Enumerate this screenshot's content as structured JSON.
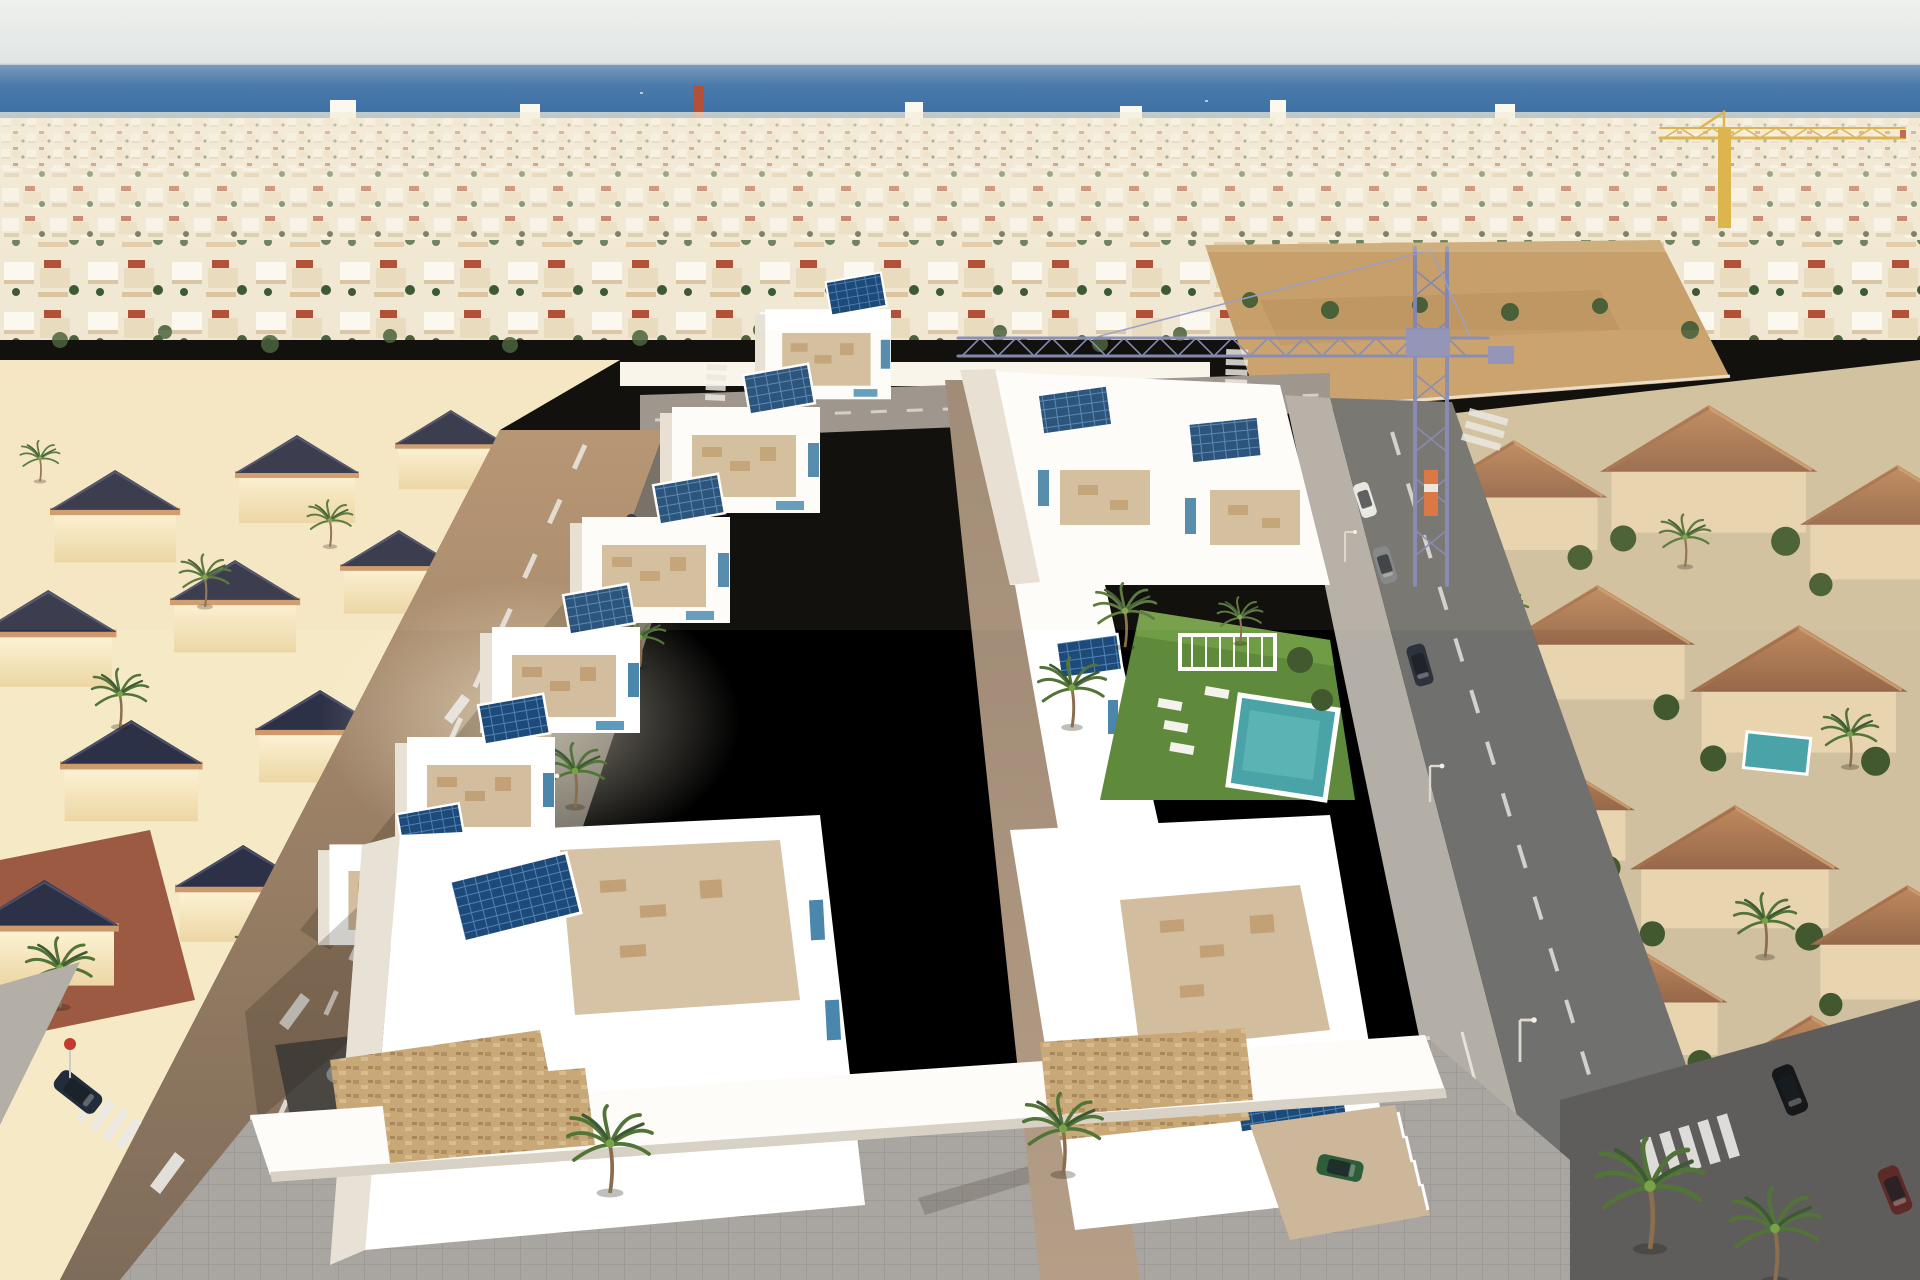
{
  "scene": {
    "title": "Aerial render of seaside villa development",
    "type": "aerial-3d-render-photograph",
    "description": "Aerial drone view of a new residential development of modern white villas with rooftop solar panels and a communal garden with swimming pool, inserted into an existing Mediterranean coastal town. The deep blue sea lies on the horizon under a pale hazy sky. A dense beige town with scattered red roofs fills the middle distance with a yellow tower crane at the right and a blue tower crane over a sandy construction lot in the center. Cream villas with dark navy pyramid roofs sit on the left, terracotta-roofed townhouses on the right, and palm-lined streets with crosswalks, parked cars and a grey paved promenade frame the bottom.",
    "elements": [
      "sky",
      "mediterranean-sea-horizon",
      "coastal-town-skyline",
      "yellow-tower-crane",
      "blue-tower-crane",
      "construction-sand-lot",
      "old-town-villas-with-navy-roofs",
      "terracotta-roof-townhouses",
      "new-development-white-villas",
      "rooftop-solar-panels",
      "roof-terraces-with-furniture",
      "communal-garden",
      "swimming-pool",
      "white-pergola",
      "sun-loungers",
      "central-walkway",
      "palm-trees",
      "left-street",
      "right-street",
      "top-street",
      "crosswalks",
      "lane-markings",
      "street-lamps",
      "parked-cars",
      "navy-car",
      "grey-van",
      "green-car-in-driveway",
      "black-car",
      "stone-clad-walls",
      "seafront-promenade"
    ]
  },
  "colors": {
    "sky_top": "#eef0ed",
    "sky_bottom": "#dfe5e3",
    "sea_deep": "#2f649d",
    "sea_light": "#7c9cbc",
    "sea_shore": "#93a9c0",
    "town_base": "#f1e8d4",
    "town_white": "#fbf8f0",
    "town_cream": "#e9dcbe",
    "town_shadow": "#d8c6a6",
    "roof_red": "#b25138",
    "roof_navy": "#2d3147",
    "wall_cream": "#f6e9c6",
    "parapet_sand": "#cf9a6b",
    "clay_terrace": "#9d5a42",
    "terracotta": "#b5815a",
    "terracotta_dark": "#96684a",
    "beige_wall": "#e8d5b0",
    "shrub_green": "#42592f",
    "dev_white": "#ffffff",
    "dev_shade": "#e8e2d6",
    "terrace_floor": "#d2bd9e",
    "furniture_tan": "#c2a176",
    "accent_blue": "#4b87ad",
    "solar_panel": "#1d4a78",
    "solar_grid": "#4f83b5",
    "walkway_tan": "#a8937e",
    "lawn_green": "#5f8a3c",
    "pool_teal": "#4aa3a6",
    "street_warm": "#a98a6c",
    "street_gray": "#70706e",
    "sidewalk_dark": "#6f6a62",
    "sidewalk_light": "#b3aea6",
    "promenade_gray": "#a9a5a0",
    "asphalt_dark": "#5e5d5c",
    "stripe_white": "#eceae6",
    "sand_lot": "#c79f6a",
    "stone_wall": "#c9a878",
    "palm_dark": "#3d5a33",
    "palm_mid": "#527438",
    "palm_light": "#79a24a",
    "palm_trunk": "#8a6e4e",
    "crane_blue": "#8187b5",
    "crane_yellow": "#d8a72c",
    "car_navy": "#232c3a",
    "car_green": "#2f5d3b",
    "car_gray": "#7d8287",
    "car_white": "#e9e9e7",
    "car_black": "#151719",
    "car_red": "#5d2a28",
    "shadow_tint": "rgba(40,30,20,0.22)"
  }
}
